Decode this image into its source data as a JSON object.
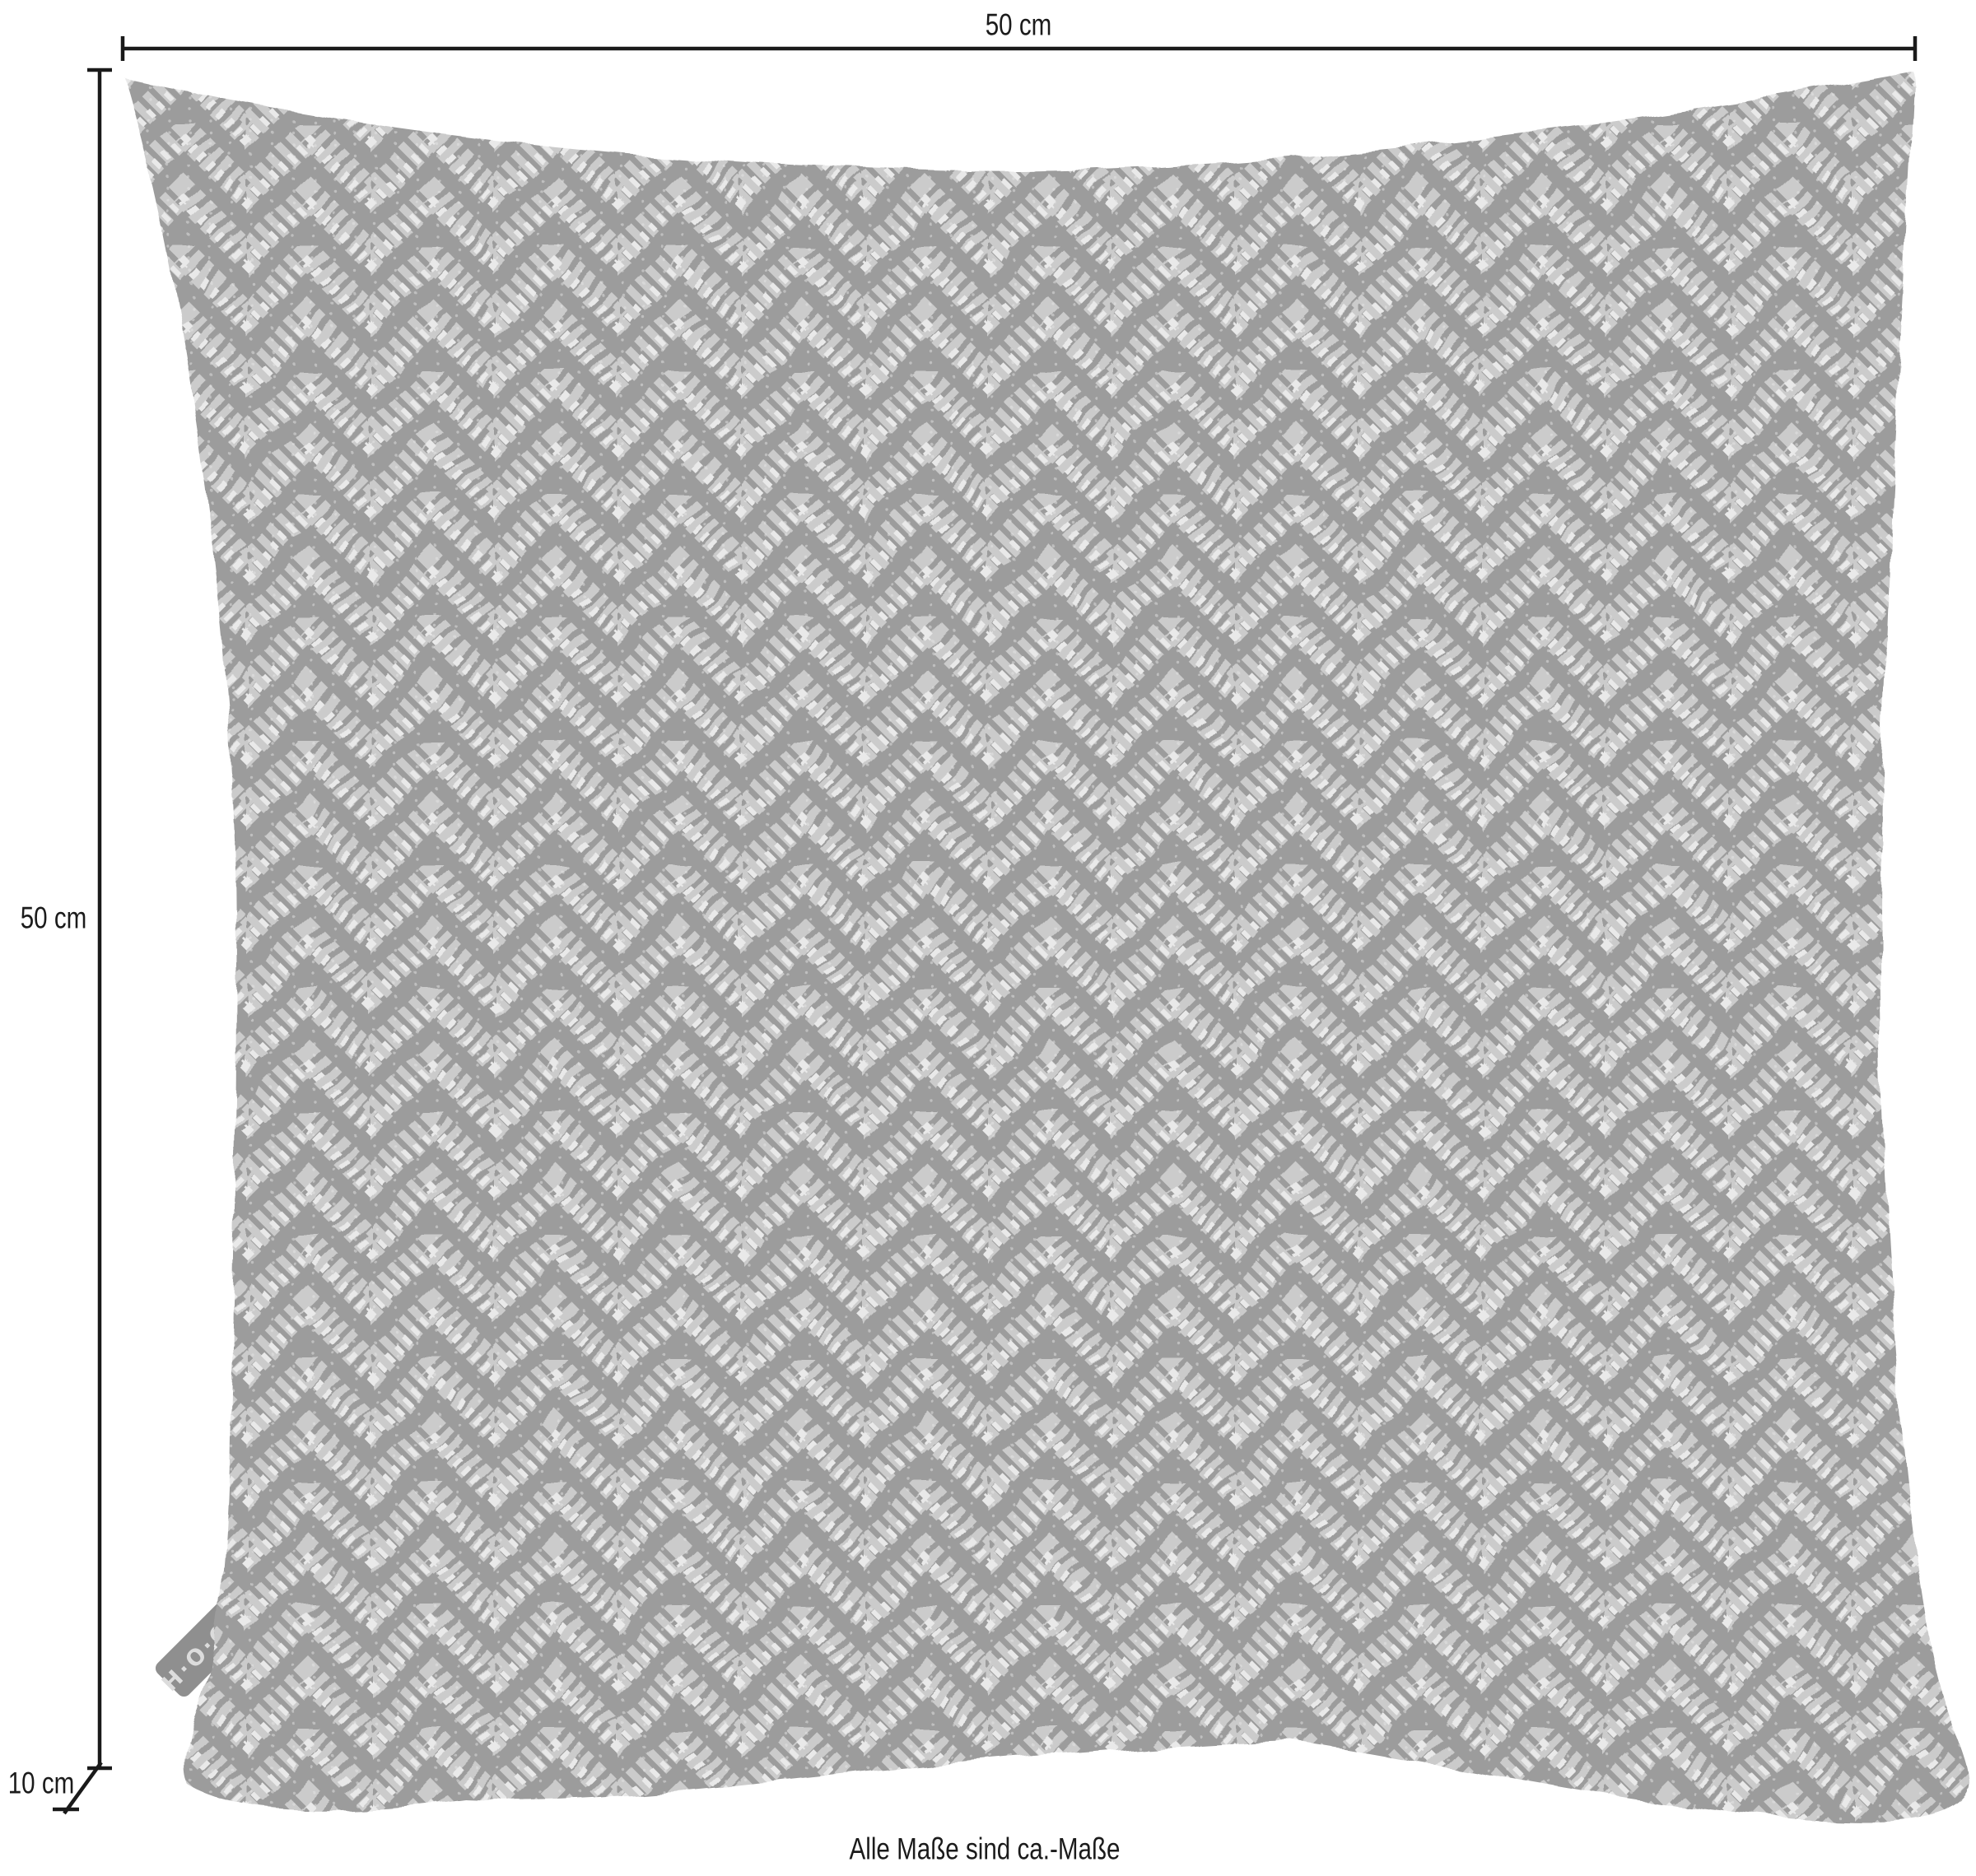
{
  "product": {
    "tag_label": "H·O·C·K"
  },
  "dimensions": {
    "width": "50 cm",
    "height": "50 cm",
    "depth": "10 cm"
  },
  "footer": {
    "note": "Alle Maße sind ca.-Maße"
  },
  "colors": {
    "line": "#1a1a1a",
    "fabric_base": "#9c9c9c",
    "fabric_band": "#cbcbcb",
    "fabric_highlight": "#e9e9e9",
    "tag_bg": "#8f8f8f",
    "tag_text": "#dcdcdc"
  }
}
